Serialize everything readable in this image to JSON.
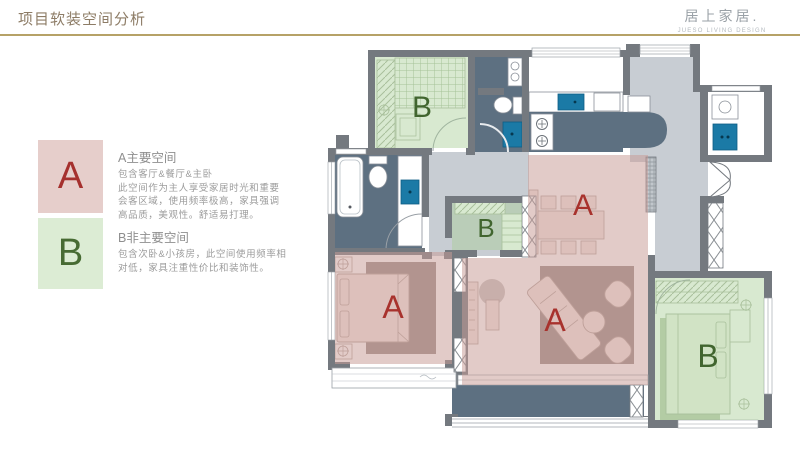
{
  "header": {
    "title": "项目软装空间分析",
    "brand": "居上家居.",
    "brand_sub": "JUESO LIVING DESIGN"
  },
  "legend": {
    "primary": {
      "letter": "A",
      "title": "A主要空间",
      "desc_lines": [
        "包含客厅&餐厅&主卧",
        "此空间作为主人享受家居时光和重要",
        "会客区域，使用频率极高，家具强调",
        "高品质，美观性。舒适易打理。"
      ]
    },
    "secondary": {
      "letter": "B",
      "title": "B非主要空间",
      "desc_lines": [
        "包含次卧&小孩房，此空间使用频率相",
        "对低，家具注重性价比和装饰性。"
      ]
    }
  },
  "plan": {
    "labels": [
      {
        "room": "bedroom-top-left",
        "text": "B"
      },
      {
        "room": "kids-room-center",
        "text": "B"
      },
      {
        "room": "bedroom-bottom-right",
        "text": "B"
      },
      {
        "room": "dining-room",
        "text": "A"
      },
      {
        "room": "living-room",
        "text": "A"
      },
      {
        "room": "master-bedroom",
        "text": "A"
      }
    ]
  },
  "colors": {
    "accent_line": "#b6a267",
    "primary_zone": "#dfc8c4",
    "primary_letter": "#a5302e",
    "secondary_zone": "#dbeccf",
    "secondary_letter": "#41652f",
    "wall": "#74797f",
    "wet_floor": "#5d7081",
    "fixture_blue": "#1b7aa6"
  }
}
